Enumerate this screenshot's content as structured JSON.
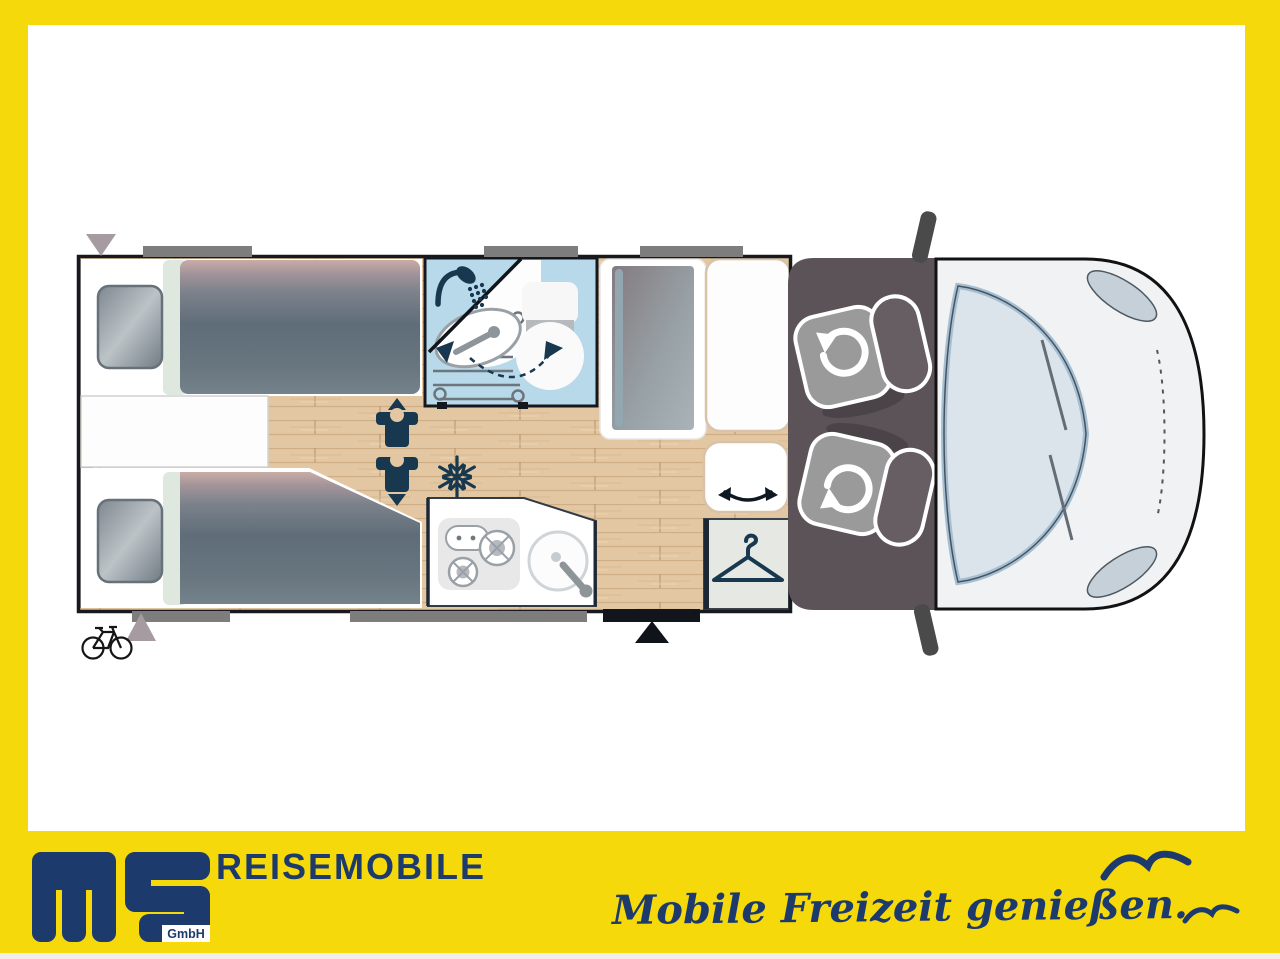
{
  "brand": {
    "logo_monogram": "ms",
    "gmbh": "GmbH",
    "wordmark": "REISEMOBILE",
    "tagline": "Mobile Freizeit genießen."
  },
  "colors": {
    "accent_yellow": "#F6D90A",
    "brand_navy": "#1D3A6D",
    "icon_navy": "#17384E",
    "wood_floor": "#E3C7A2",
    "bathroom_blue": "#B7D9E9",
    "cab_floor_gray": "#5B5357",
    "bed_slate": "#5F6D79",
    "bed_pink": "#C9ACA6",
    "mint_band": "#DFE8DF",
    "vehicle_body": "#F1F2F4",
    "windshield_blue": "#DCE4EB",
    "window_bar_gray": "#7D7D7D",
    "tan_outline": "#D9C3A8"
  },
  "icons": [
    "shower-icon",
    "washbasin-icon",
    "toilet-icon",
    "swivel-door-arrow-icon",
    "fridge-icon",
    "snowflake-icon",
    "travel-seat-up-icon",
    "travel-seat-down-icon",
    "swivel-bench-arrow-icon",
    "hanger-icon",
    "swivel-cab-seat-icon",
    "bicycle-icon",
    "entry-door-marker-icon",
    "rear-marker-triangle-icon",
    "side-mirror-icon",
    "seagull-icon"
  ],
  "floorplan_areas": [
    "twin-single-beds",
    "center-shelf",
    "bathroom",
    "refrigerator",
    "tall-cabinet",
    "travel-bench",
    "wardrobe",
    "kitchen-block",
    "entry-door",
    "cab-swivel-seats",
    "vehicle-front"
  ]
}
